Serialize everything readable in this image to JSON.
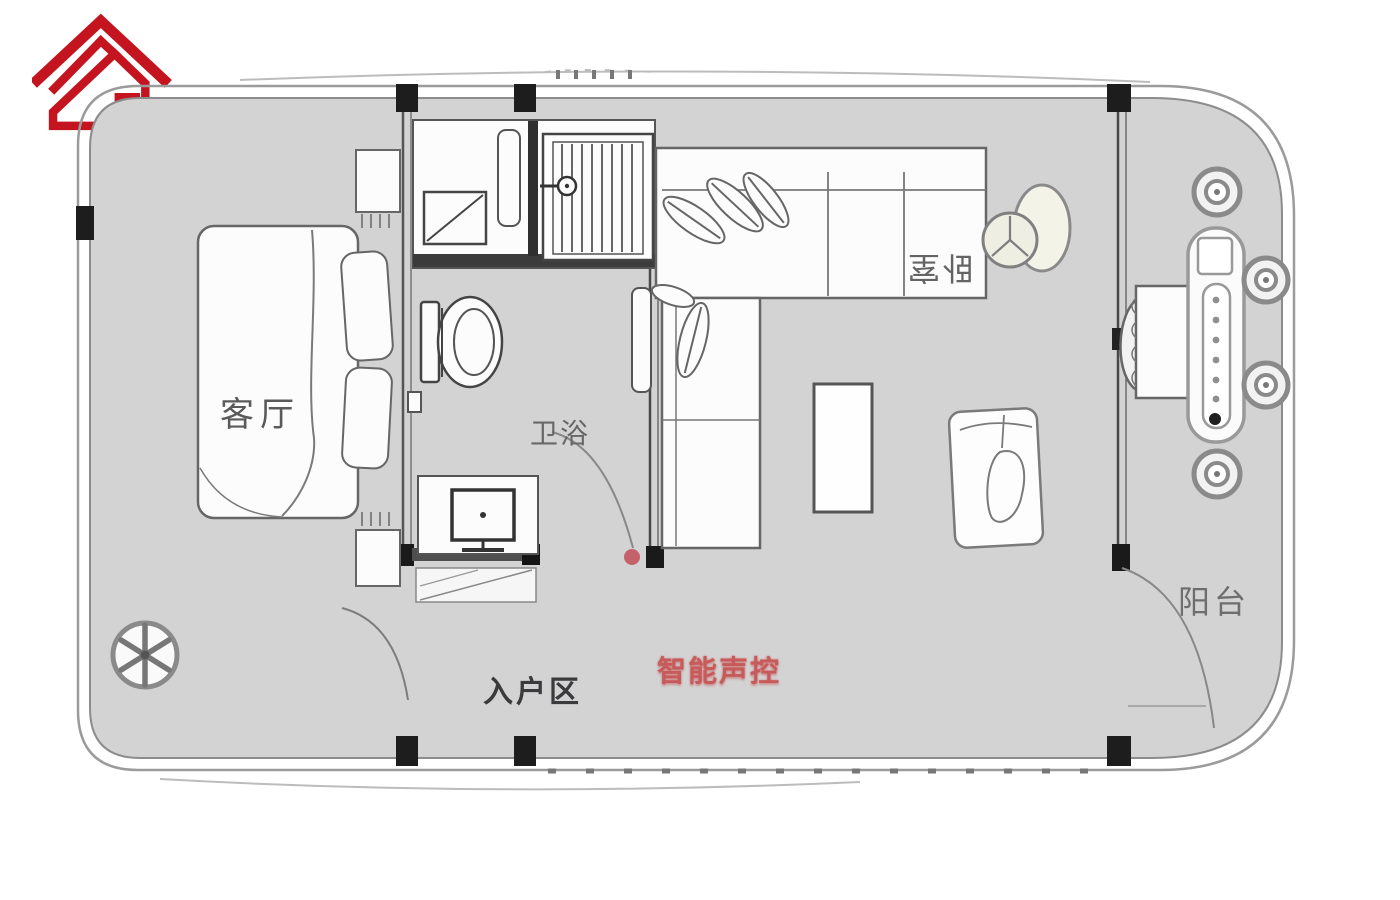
{
  "logo": {
    "monogram": "ZG",
    "type": "house-roof-monogram",
    "color": "#c3141f"
  },
  "plan": {
    "rooms": {
      "living_room": "客厅",
      "bathroom": "卫浴",
      "bedroom": "卧室",
      "entrance": "入户区",
      "balcony": "阳台"
    },
    "annotations": {
      "smart_voice": "智能声控"
    },
    "colors": {
      "floor_gray": "#d3d3d3",
      "wall_dark": "#1d1d1d",
      "line_gray": "#5a5a5a",
      "furniture_fill": "#fcfcfc",
      "annotation_red": "#c75b5b",
      "door_dot_red": "#c4616b",
      "logo_red": "#c3141f"
    },
    "symbols": {
      "floor_drain": "asterisk-circle",
      "stools": "ring-circle",
      "fan": "double-circle-fan",
      "shower": "striped-rect",
      "door_swing": "quarter-arc"
    }
  }
}
